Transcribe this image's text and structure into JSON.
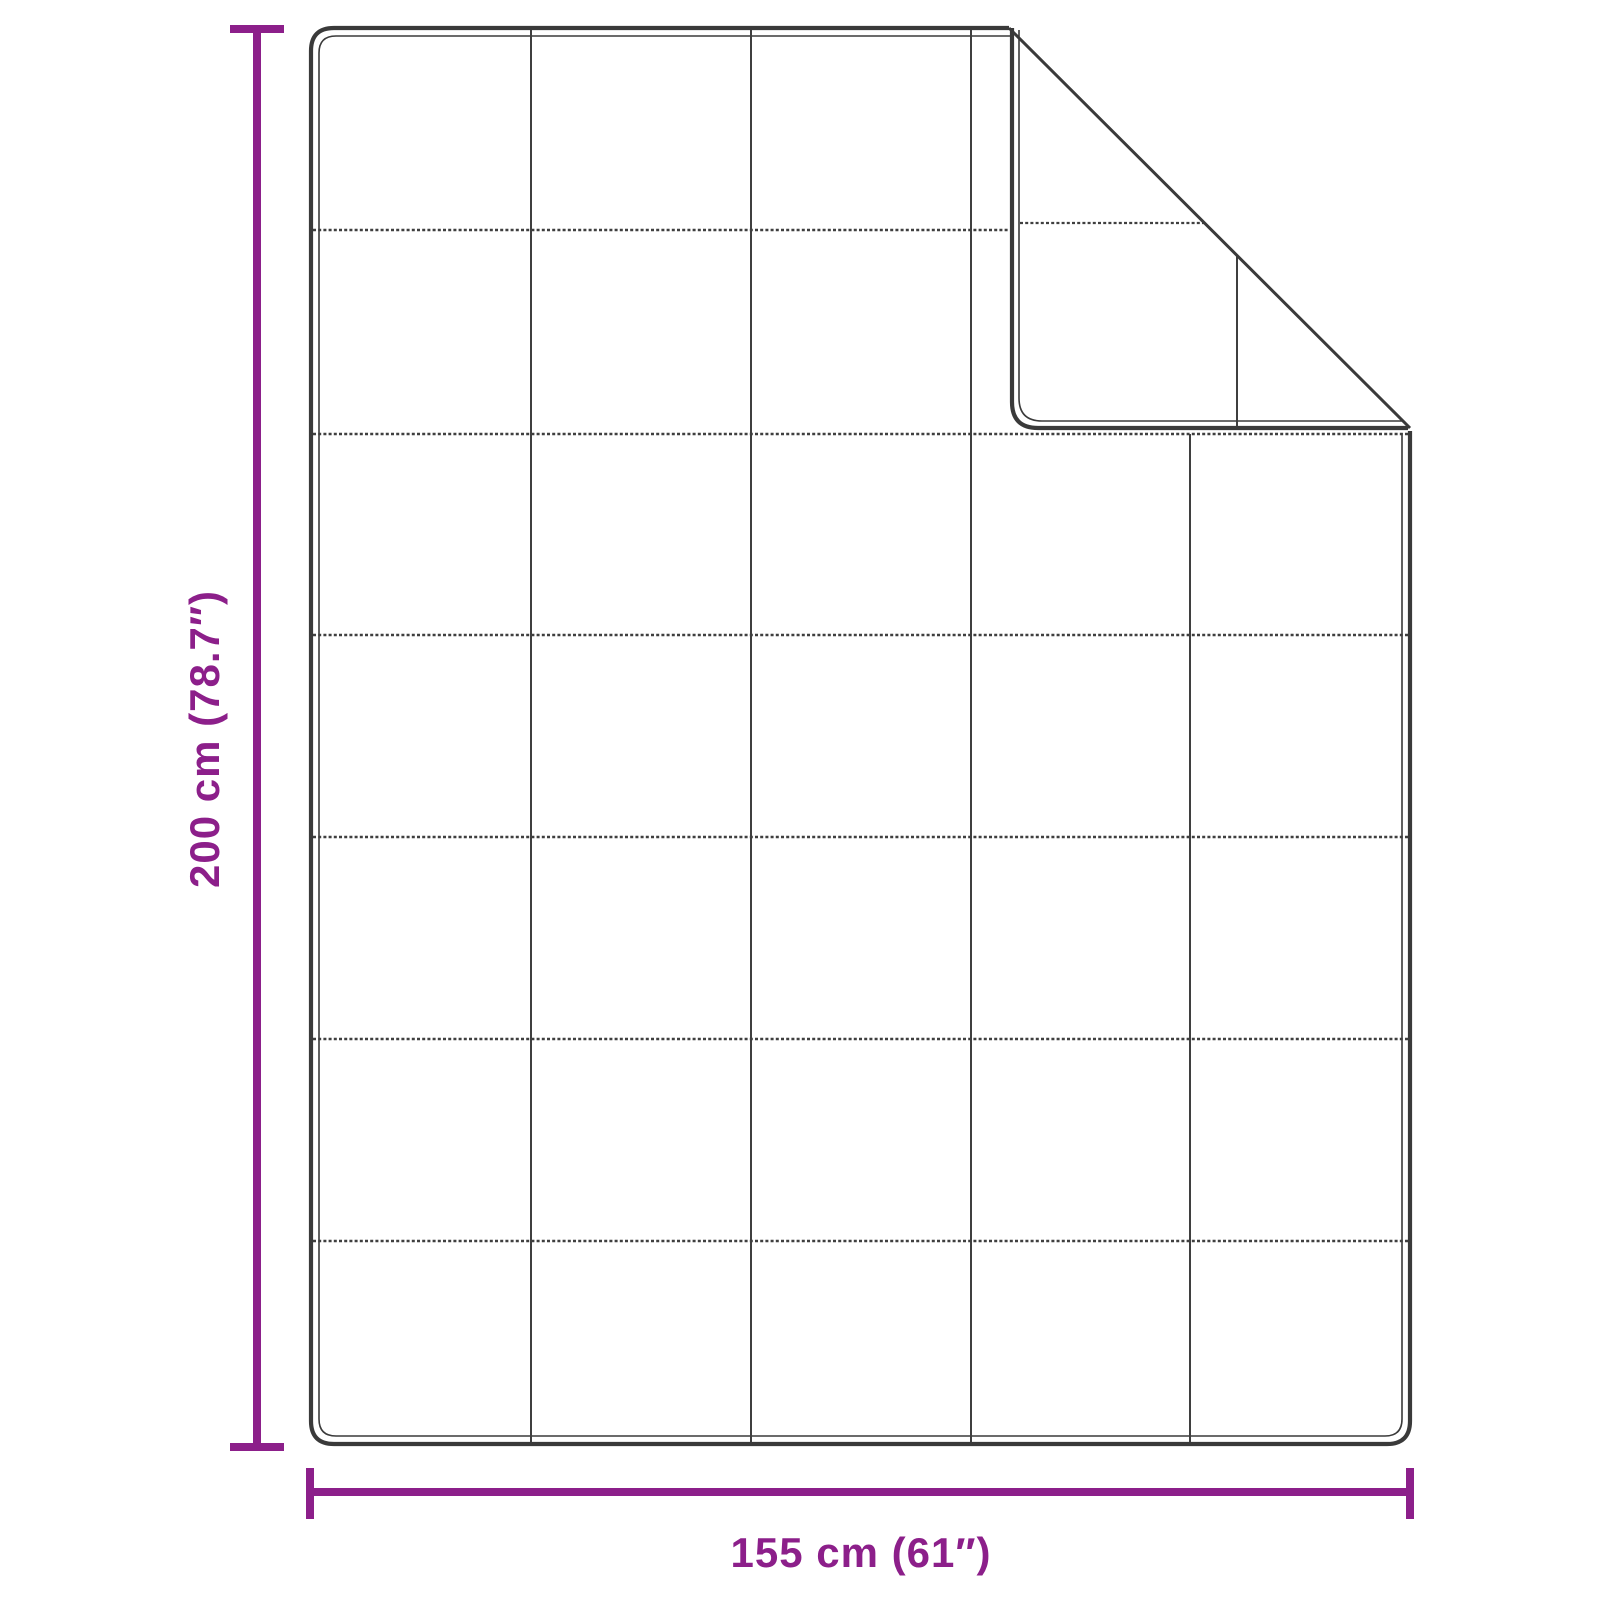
{
  "diagram": {
    "kind": "product-dimension-diagram",
    "subject": "quilted-blanket-with-folded-corner",
    "labels": {
      "height": "200 cm (78.7″)",
      "width": "155 cm (61″)"
    },
    "grid": {
      "columns": 5,
      "rows": 7
    },
    "colors": {
      "dimension_accent": "#8C1F8A",
      "outline": "#3A3A3A",
      "grid_line": "#3F3F3F",
      "background": "#FFFFFF"
    }
  }
}
